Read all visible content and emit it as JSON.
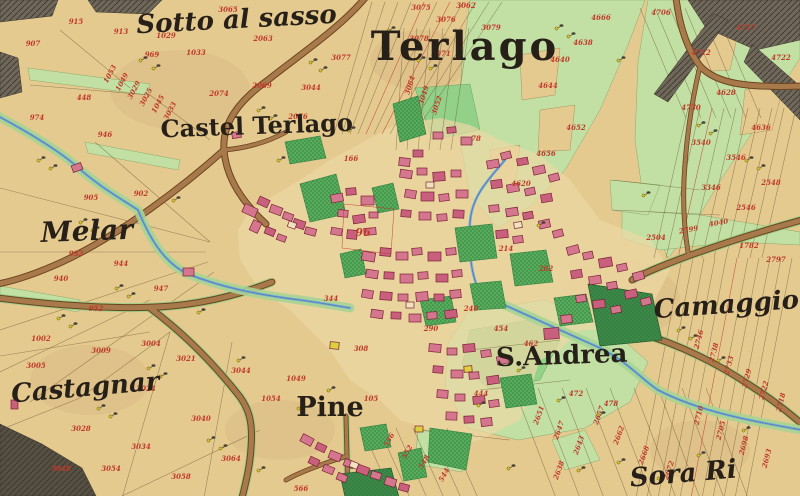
{
  "map": {
    "title": "Terlago",
    "colors": {
      "paper": "#e5ca90",
      "paperLight": "#ecd8a4",
      "road": "#a8794a",
      "roadEdge": "#6b4622",
      "roadMargin": "#98cd85",
      "meadow": "#c3e0a4",
      "meadowBright": "#93d189",
      "garden": "#56ad5c",
      "gardenDark": "#3c8a48",
      "water": "#76a8d8",
      "waterBank": "#a6d494",
      "rock": "#6e675a",
      "rockDark": "#565043",
      "parcelLine": "#5d4a28",
      "redInk": "#c0392b",
      "inkBlack": "#272019"
    },
    "place_labels": [
      {
        "id": "sotto-al-sasso",
        "text": "Sotto al sasso",
        "x": 237,
        "y": 28,
        "style": "script",
        "size": 26,
        "rotate": -3
      },
      {
        "id": "terlago",
        "text": "Terlago",
        "x": 465,
        "y": 60,
        "style": "serif",
        "size": 40,
        "rotate": 0,
        "spacing": 3
      },
      {
        "id": "castel-terlago",
        "text": "Castel Terlago",
        "x": 257,
        "y": 134,
        "style": "serif",
        "size": 24,
        "rotate": -2
      },
      {
        "id": "melar",
        "text": "Melar",
        "x": 41,
        "y": 242,
        "style": "script",
        "size": 28,
        "rotate": -2,
        "anchor": "start"
      },
      {
        "id": "castagnar",
        "text": "Castagnar",
        "x": 86,
        "y": 396,
        "style": "script",
        "size": 26,
        "rotate": -5
      },
      {
        "id": "pine",
        "text": "Pine",
        "x": 330,
        "y": 416,
        "style": "serif",
        "size": 27,
        "rotate": 0
      },
      {
        "id": "s-andrea",
        "text": "S.Andrea",
        "x": 562,
        "y": 364,
        "style": "serif",
        "size": 26,
        "rotate": -2
      },
      {
        "id": "camaggiore",
        "text": "Camaggiore",
        "x": 742,
        "y": 312,
        "style": "script",
        "size": 26,
        "rotate": -4
      },
      {
        "id": "sora-ri",
        "text": "Sora Ri",
        "x": 684,
        "y": 482,
        "style": "script",
        "size": 26,
        "rotate": -5
      }
    ],
    "special_parcel": {
      "v": "96",
      "x": 363,
      "y": 236
    },
    "parcel_numbers": [
      [
        33,
        46,
        "907",
        0
      ],
      [
        76,
        24,
        "915",
        0
      ],
      [
        105,
        137,
        "946",
        0
      ],
      [
        84,
        100,
        "448",
        0
      ],
      [
        37,
        120,
        "974",
        0
      ],
      [
        121,
        34,
        "913",
        0
      ],
      [
        152,
        57,
        "969",
        0
      ],
      [
        112,
        75,
        "1053",
        -62
      ],
      [
        124,
        83,
        "1049",
        -62
      ],
      [
        136,
        91,
        "3029",
        -62
      ],
      [
        148,
        98,
        "3025",
        -62
      ],
      [
        160,
        105,
        "1045",
        -62
      ],
      [
        172,
        112,
        "3033",
        -62
      ],
      [
        228,
        12,
        "3065",
        0
      ],
      [
        263,
        41,
        "2063",
        0
      ],
      [
        196,
        55,
        "1033",
        0
      ],
      [
        166,
        38,
        "1029",
        0
      ],
      [
        311,
        90,
        "3044",
        0
      ],
      [
        341,
        60,
        "3077",
        0
      ],
      [
        262,
        88,
        "2069",
        0
      ],
      [
        219,
        96,
        "2074",
        0
      ],
      [
        298,
        119,
        "2076",
        0
      ],
      [
        421,
        10,
        "3075",
        0
      ],
      [
        446,
        22,
        "3076",
        0
      ],
      [
        466,
        8,
        "3062",
        0
      ],
      [
        491,
        30,
        "3079",
        0
      ],
      [
        419,
        41,
        "3078",
        0
      ],
      [
        441,
        56,
        "3071",
        0
      ],
      [
        412,
        86,
        "3064",
        -72
      ],
      [
        426,
        96,
        "3049",
        -72
      ],
      [
        439,
        106,
        "3052",
        -72
      ],
      [
        560,
        62,
        "4640",
        0
      ],
      [
        548,
        88,
        "4644",
        0
      ],
      [
        583,
        45,
        "4638",
        0
      ],
      [
        601,
        20,
        "4666",
        0
      ],
      [
        576,
        130,
        "4652",
        0
      ],
      [
        546,
        156,
        "4656",
        0
      ],
      [
        521,
        186,
        "4620",
        0
      ],
      [
        661,
        15,
        "4706",
        0
      ],
      [
        701,
        55,
        "4712",
        0
      ],
      [
        746,
        30,
        "4717",
        0
      ],
      [
        781,
        60,
        "4722",
        0
      ],
      [
        691,
        110,
        "4730",
        0
      ],
      [
        726,
        95,
        "4628",
        0
      ],
      [
        761,
        130,
        "4636",
        0
      ],
      [
        736,
        160,
        "3546",
        0
      ],
      [
        701,
        145,
        "3540",
        0
      ],
      [
        771,
        185,
        "2548",
        0
      ],
      [
        746,
        210,
        "2546",
        0
      ],
      [
        711,
        190,
        "3346",
        0
      ],
      [
        656,
        240,
        "2504",
        0
      ],
      [
        689,
        232,
        "2799",
        -10
      ],
      [
        719,
        225,
        "4040",
        -10
      ],
      [
        749,
        248,
        "1782",
        0
      ],
      [
        776,
        262,
        "2797",
        0
      ],
      [
        701,
        340,
        "2746",
        -75
      ],
      [
        716,
        353,
        "2738",
        -75
      ],
      [
        731,
        366,
        "2733",
        -75
      ],
      [
        749,
        379,
        "2729",
        -75
      ],
      [
        766,
        391,
        "2722",
        -75
      ],
      [
        783,
        403,
        "2718",
        -75
      ],
      [
        701,
        416,
        "2710",
        -75
      ],
      [
        723,
        431,
        "2705",
        -75
      ],
      [
        746,
        446,
        "2698",
        -75
      ],
      [
        769,
        459,
        "2693",
        -75
      ],
      [
        541,
        416,
        "2651",
        -70
      ],
      [
        561,
        431,
        "2647",
        -70
      ],
      [
        581,
        446,
        "2643",
        -70
      ],
      [
        601,
        416,
        "2657",
        -70
      ],
      [
        621,
        436,
        "2662",
        -70
      ],
      [
        646,
        456,
        "2668",
        -70
      ],
      [
        671,
        471,
        "2672",
        -70
      ],
      [
        561,
        471,
        "2638",
        -70
      ],
      [
        501,
        331,
        "454",
        0
      ],
      [
        531,
        346,
        "462",
        0
      ],
      [
        576,
        396,
        "472",
        0
      ],
      [
        611,
        406,
        "478",
        0
      ],
      [
        481,
        396,
        "444",
        0
      ],
      [
        91,
        200,
        "905",
        0
      ],
      [
        141,
        196,
        "902",
        0
      ],
      [
        61,
        281,
        "940",
        0
      ],
      [
        121,
        266,
        "944",
        0
      ],
      [
        96,
        311,
        "952",
        0
      ],
      [
        161,
        291,
        "947",
        0
      ],
      [
        41,
        341,
        "1002",
        0
      ],
      [
        151,
        346,
        "3004",
        0
      ],
      [
        76,
        256,
        "932",
        0
      ],
      [
        36,
        368,
        "3005",
        0
      ],
      [
        101,
        353,
        "3009",
        0
      ],
      [
        186,
        361,
        "3021",
        0
      ],
      [
        146,
        391,
        "3024",
        0
      ],
      [
        81,
        431,
        "3028",
        0
      ],
      [
        141,
        449,
        "3034",
        0
      ],
      [
        201,
        421,
        "3040",
        0
      ],
      [
        241,
        373,
        "3044",
        0
      ],
      [
        61,
        471,
        "3048",
        0
      ],
      [
        111,
        471,
        "3054",
        0
      ],
      [
        181,
        479,
        "3058",
        0
      ],
      [
        231,
        461,
        "3064",
        0
      ],
      [
        271,
        401,
        "1054",
        0
      ],
      [
        296,
        381,
        "1049",
        0
      ],
      [
        371,
        401,
        "105",
        0
      ],
      [
        391,
        441,
        "556",
        -60
      ],
      [
        409,
        453,
        "552",
        -60
      ],
      [
        426,
        463,
        "548",
        -60
      ],
      [
        446,
        476,
        "544",
        -60
      ],
      [
        301,
        491,
        "566",
        0
      ],
      [
        351,
        161,
        "166",
        0
      ],
      [
        476,
        141,
        "78",
        0
      ],
      [
        331,
        301,
        "344",
        0
      ],
      [
        506,
        251,
        "214",
        0
      ],
      [
        471,
        311,
        "240",
        0
      ],
      [
        546,
        271,
        "262",
        0
      ],
      [
        361,
        351,
        "308",
        0
      ],
      [
        431,
        331,
        "290",
        0
      ]
    ]
  }
}
